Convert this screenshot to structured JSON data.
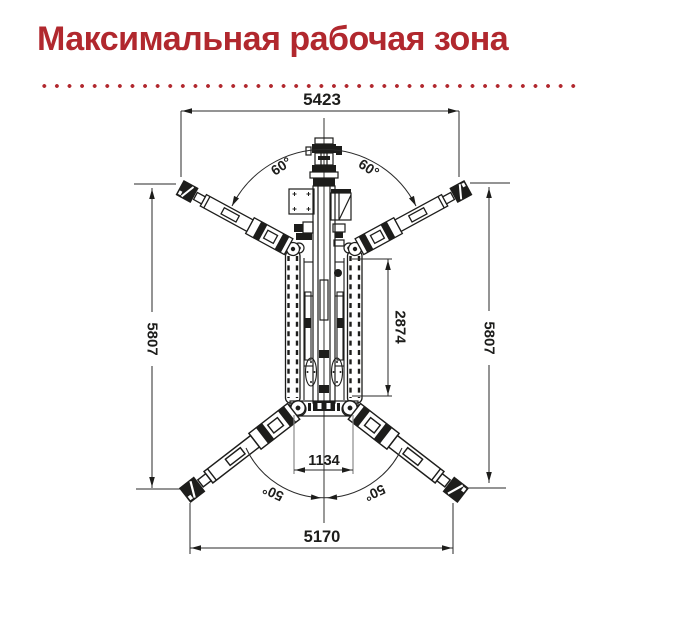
{
  "title": "Максимальная рабочая зона",
  "colors": {
    "accent": "#b1282e",
    "line": "#1d1d1b",
    "extension_gray": "#8a8a8a"
  },
  "diagram": {
    "description": "top view of spider lift with four extended outriggers",
    "dimensions": {
      "top_width": "5423",
      "left_height": "5807",
      "right_height": "5807",
      "track_length": "2874",
      "inner_width": "1134",
      "bottom_width": "5170"
    },
    "angles": {
      "top_left": "60°",
      "top_right": "60°",
      "bottom_left": "50°",
      "bottom_right": "50°"
    }
  }
}
